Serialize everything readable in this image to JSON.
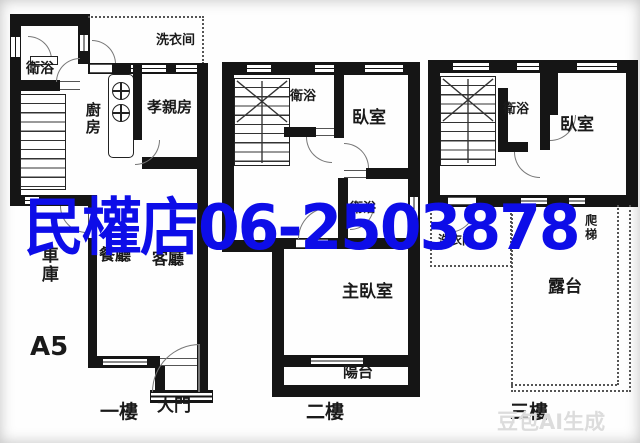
{
  "watermark": {
    "store_name": "民權店",
    "phone": "06-2503878",
    "color": "#0d0de8"
  },
  "ai_watermark": {
    "text": "豆包AI生成"
  },
  "unit_code": "A5",
  "floor1": {
    "floor_label": "一樓",
    "bathroom": "衛浴",
    "laundry": "洗衣间",
    "kitchen": "廚房",
    "parents_room": "孝親房",
    "garage": "車庫",
    "dining_room": "餐廳",
    "living_room": "客廳",
    "main_door": "大門"
  },
  "floor2": {
    "floor_label": "二樓",
    "bathroom_upper": "衛浴",
    "bedroom": "臥室",
    "bathroom_lower": "衛浴",
    "master_bedroom": "主臥室",
    "balcony": "陽台"
  },
  "floor3": {
    "floor_label": "三樓",
    "bathroom": "衛浴",
    "bedroom": "臥室",
    "laundry": "洗衣间",
    "ladder": "爬梯",
    "terrace": "露台"
  }
}
